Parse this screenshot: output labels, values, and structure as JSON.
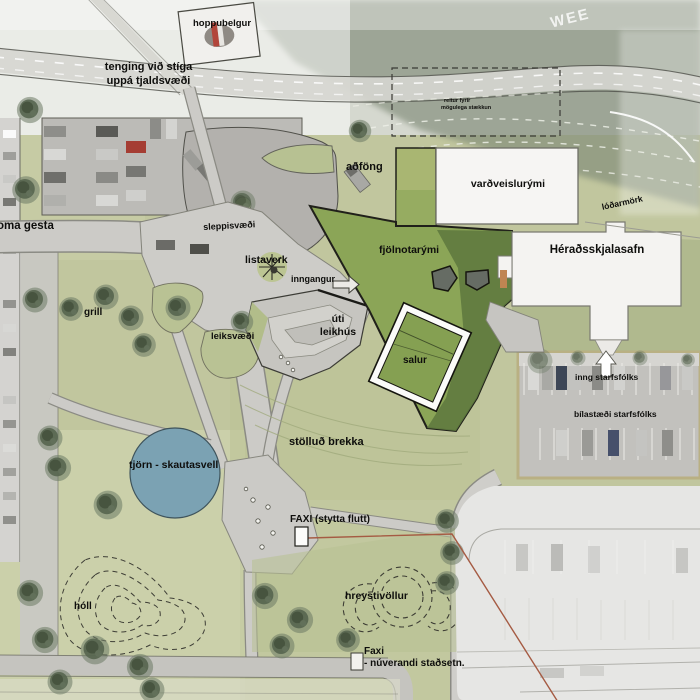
{
  "map_title": "landscape site plan",
  "labels": {
    "hoppubelgur": "hoppubelgur",
    "tenging_line1": "tenging við stíga",
    "tenging_line2": "uppá tjaldsvæði",
    "terrain_marking": "WEE",
    "expansion_line1": "reitur fyrir",
    "expansion_line2": "mögulega stækkun",
    "adfong": "aðföng",
    "vardveislurymi": "varðveislurými",
    "lodarmork": "lóðarmörk",
    "heradsskjalasafn": "Héraðsskjalasafn",
    "fjolnotarymi": "fjölnotarými",
    "listaverk": "listaverk",
    "inngangur": "inngangur",
    "sleppisvaedi": "sleppisvæði",
    "adkoma_gesta": "oma gesta",
    "grill": "grill",
    "leiksvaedi": "leiksvæði",
    "uti_leikhus_line1": "úti",
    "uti_leikhus_line2": "leikhús",
    "salur": "salur",
    "stollud_brekka": "stölluð brekka",
    "tjorn_skautasvell": "tjörn - skautasvell",
    "holl": "hóll",
    "faxi_new": "FAXI (stytta flutt)",
    "hreystivollur": "hreystivöllur",
    "faxi_old_line1": "Faxi",
    "faxi_old_line2": "- núverandi staðsetn.",
    "inng_starfsfolks": "inng starfsfólks",
    "bilastaedi_starfsfolks": "bílastæði starfsfólks"
  },
  "colors": {
    "grass": "#c1c69e",
    "path_gray": "#cccbc7",
    "asphalt": "#b3b1ad",
    "green_roof": "#8ba557",
    "green_roof_shadow": "#5f7a3f",
    "pond_blue": "#7ba2b3",
    "building_white": "#f6f5f3",
    "tree_green": "#57654f",
    "relocation_line_red": "#a55b43",
    "tan_curb": "#b9b083",
    "label_black": "#0e0e0c"
  }
}
